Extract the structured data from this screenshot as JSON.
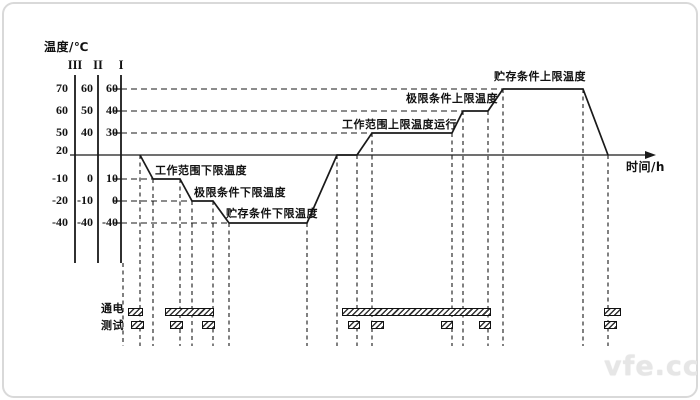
{
  "y_axis_title": "温度/℃",
  "x_axis_title": "时间/h",
  "scales": [
    {
      "name": "III",
      "values": [
        "70",
        "60",
        "50",
        "20",
        "-10",
        "-20",
        "-40"
      ]
    },
    {
      "name": "II",
      "values": [
        "60",
        "50",
        "40",
        "",
        "0",
        "-10",
        "-40"
      ]
    },
    {
      "name": "I",
      "values": [
        "60",
        "40",
        "30",
        "",
        "10",
        "0",
        "-40"
      ]
    }
  ],
  "annotations": {
    "storage_upper": {
      "text": "贮存条件上限温度",
      "level_c": 60
    },
    "limit_upper": {
      "text": "极限条件上限温度",
      "level_c": 40
    },
    "operating_upper": {
      "text": "工作范围上限温度运行",
      "level_c": 30
    },
    "operating_lower": {
      "text": "工作范围下限温度",
      "level_c": 10
    },
    "limit_lower": {
      "text": "极限条件下限温度",
      "level_c": 0
    },
    "storage_lower": {
      "text": "贮存条件下限温度",
      "level_c": -40
    }
  },
  "timeline": {
    "power_label": "通电",
    "test_label": "测试"
  },
  "profile_sequence_c": [
    20,
    10,
    0,
    -40,
    20,
    30,
    40,
    60,
    20
  ],
  "watermark": "vfe.cc",
  "colors": {
    "line": "#1a1a1a",
    "border": "#d9d9d9",
    "watermark": "#e6e6e6"
  }
}
